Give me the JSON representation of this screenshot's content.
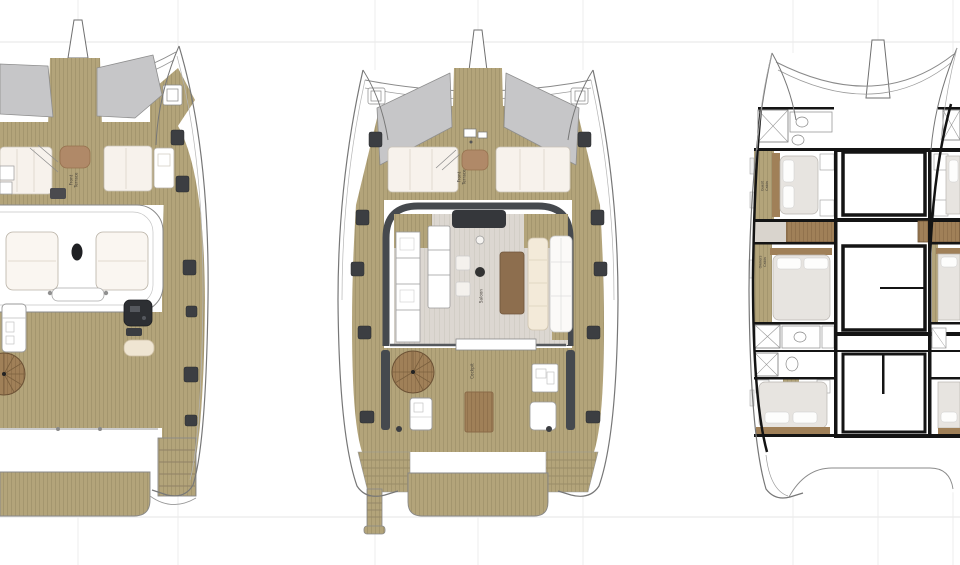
{
  "drawing": {
    "description": "Catamaran deck plans, three top views",
    "plans": {
      "flybridge_deck": {
        "front_terrace": [
          "Front",
          "Terrace"
        ]
      },
      "main_deck": {
        "front_terrace": [
          "Front",
          "Terrace"
        ],
        "saloon": "Saloon",
        "cockpit": "Cockpit"
      },
      "lower_deck": {
        "guest_cabin": [
          "Guest",
          "Cabin"
        ],
        "owners_cabin": [
          "Owners",
          "Cabin"
        ]
      }
    },
    "colors": {
      "deck_wood": "#b3a47a",
      "deck_wood_grain": "#a1936a",
      "step_wood": "#a08058",
      "glass_gray": "#c6c6c8",
      "cushion_cream": "#f7f2ec",
      "sofa_cream": "#f3ead9",
      "saloon_floor": "#dcd7d1",
      "hatch_dark": "#3c3e42",
      "superstructure_dark": "#45494e",
      "wall_black": "#141414",
      "table_brown": "#8d6e4e",
      "chaise_brown": "#b08968",
      "construction_line": "#e5e5e5"
    }
  }
}
